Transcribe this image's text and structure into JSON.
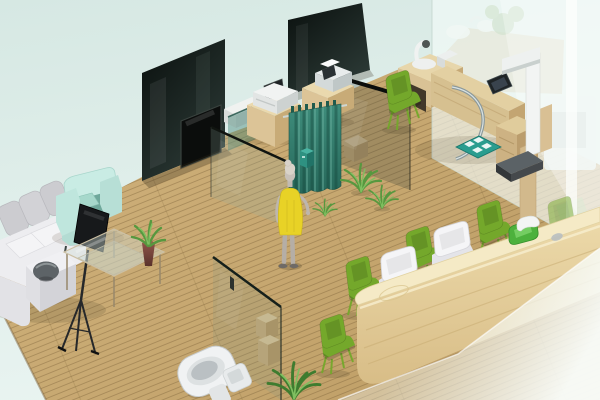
{
  "meta": {
    "type": "3d-isometric-interior-render",
    "description": "Isometric 3D rendering of a clinic / office interior: lounge with white sectional sofa and teal armchair, glass coffee table, dark glass media partitions, teal privacy curtain with a person in a yellow dress, wooden examination desk with equipment and stadiometer scale, glass restroom partition with toilet, green waiting chairs and a long wooden reception counter behind frosted glass panes, all on a wooden plank floor over a pale mint background.",
    "canvas": {
      "width": 600,
      "height": 400
    }
  },
  "colors": {
    "background_top": "#d6e8e3",
    "background_bottom": "#e9f4f1",
    "floor_light": "#d1b37d",
    "floor_dark": "#bf9f67",
    "plank_line": "#76603a",
    "dark_glass_top": "#0a100e",
    "dark_glass_bottom": "#2c3a36",
    "clear_glass_tint": "#91aca0",
    "curtain_light": "#3f8d7c",
    "curtain_dark": "#26685a",
    "wood_light": "#ead9ae",
    "wood_mid": "#dcc497",
    "wood_shadow": "#c8ab77",
    "counter_top": "#f5eac6",
    "counter_front_light": "#ecd9a9",
    "counter_front_dark": "#d8bd87",
    "chair_green": "#74a82b",
    "sofa_white": "#ededf0",
    "sofa_gray": "#ccccd0",
    "armchair_teal": "#c9ece4",
    "armchair_seat": "#6fa89b",
    "dress_yellow": "#e8d226",
    "skin_gray": "#c8c1b9",
    "plant_green": "#57983f",
    "plant_green_light": "#7fbf60",
    "vase_light": "#8d5348",
    "vase_dark": "#5a322b",
    "toilet_white": "#f0f2f3",
    "chrome": "#8b999b",
    "frost_glass": "#f3faf8",
    "mat_teal": "#2a9d8f",
    "equipment_white": "#f1f3f2",
    "device_dark": "#1f2426",
    "bin_teal": "#2e9181",
    "tray_green": "#4db13d"
  },
  "scene": {
    "objects": [
      {
        "id": "background",
        "label": "Pale mint backdrop"
      },
      {
        "id": "wood-floor",
        "label": "Wooden plank floor"
      },
      {
        "id": "dark-glass-partition-left",
        "label": "Dark glass media wall"
      },
      {
        "id": "wall-tv",
        "label": "Wall mounted TV"
      },
      {
        "id": "dark-glass-partition-back",
        "label": "Dark glass partition"
      },
      {
        "id": "white-shelf",
        "label": "White side table"
      },
      {
        "id": "teal-glass-panel",
        "label": "Teal tinted glass panel"
      },
      {
        "id": "glass-partition-lounge",
        "label": "Clear glass partition (lounge)"
      },
      {
        "id": "glass-partition-exam",
        "label": "Clear glass partition (exam room)"
      },
      {
        "id": "small-stool",
        "label": "Small wooden stool"
      },
      {
        "id": "printer-cabinet",
        "label": "Wooden cabinet with printer"
      },
      {
        "id": "printer",
        "label": "White printer with tablet"
      },
      {
        "id": "fax-cabinet",
        "label": "Wooden cabinet with fax machine"
      },
      {
        "id": "fax-machine",
        "label": "Gray fax / card machine"
      },
      {
        "id": "curtain-rail",
        "label": "Curtain rail"
      },
      {
        "id": "privacy-curtain",
        "label": "Teal privacy curtain"
      },
      {
        "id": "storage-bin",
        "label": "Small teal bin"
      },
      {
        "id": "person-figure",
        "label": "Person in yellow dress"
      },
      {
        "id": "floor-plant-1",
        "label": "Floor plant"
      },
      {
        "id": "floor-plant-2",
        "label": "Floor plant"
      },
      {
        "id": "floor-plant-3",
        "label": "Floor plant"
      },
      {
        "id": "bottom-plant",
        "label": "Floor plant by glass wall"
      },
      {
        "id": "exam-desk",
        "label": "Wooden examination desk"
      },
      {
        "id": "desk-equipment",
        "label": "White exam equipment"
      },
      {
        "id": "desk-tablet",
        "label": "Dark tablet on desk"
      },
      {
        "id": "chrome-stand",
        "label": "Curved chrome tube"
      },
      {
        "id": "floor-mat",
        "label": "Teal floor mat"
      },
      {
        "id": "stadiometer",
        "label": "Height scale with platform"
      },
      {
        "id": "desk-chair",
        "label": "Green desk chair"
      },
      {
        "id": "restroom-partition",
        "label": "Glass restroom partition"
      },
      {
        "id": "partition-handle",
        "label": "Door handle"
      },
      {
        "id": "shelf-boxes",
        "label": "Wooden shelf boxes behind glass"
      },
      {
        "id": "toilet",
        "label": "White toilet"
      },
      {
        "id": "sectional-sofa",
        "label": "White sectional sofa"
      },
      {
        "id": "sofa-bowl",
        "label": "Dark decorative bowl"
      },
      {
        "id": "accent-armchair",
        "label": "Teal accent armchair"
      },
      {
        "id": "display-stand",
        "label": "Black display screen on tripod"
      },
      {
        "id": "coffee-table",
        "label": "Glass coffee table"
      },
      {
        "id": "plant-vase",
        "label": "Maroon vase with aloe"
      },
      {
        "id": "waiting-chairs",
        "label": "Green waiting chairs"
      },
      {
        "id": "reception-counter",
        "label": "Long wooden reception counter"
      },
      {
        "id": "reception-chairs",
        "label": "White reception chairs"
      },
      {
        "id": "counter-tray",
        "label": "Green tray with white handset"
      },
      {
        "id": "frosted-wall",
        "label": "Frosted glass wall (right)"
      },
      {
        "id": "behind-glass-counter",
        "label": "Counter behind frosted glass"
      },
      {
        "id": "behind-glass-machine",
        "label": "Equipment behind frosted glass"
      },
      {
        "id": "foreground-glass",
        "label": "Foreground frosted glass pane"
      }
    ]
  }
}
